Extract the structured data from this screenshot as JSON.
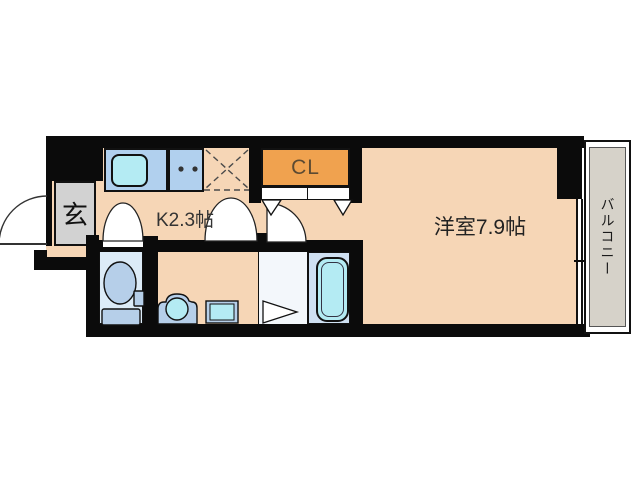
{
  "plan": {
    "type": "apartment-floor-plan",
    "rooms": {
      "entrance": {
        "label": "玄"
      },
      "kitchen": {
        "label": "K2.3帖"
      },
      "closet": {
        "label": "CL"
      },
      "main_room": {
        "label": "洋室7.9帖"
      },
      "balcony": {
        "label": "バルコニー"
      }
    },
    "features": [
      "sink",
      "two-burner-stove",
      "refrigerator-space",
      "toilet",
      "washing-machine-pan",
      "vanity-sink",
      "bathtub",
      "sliding-window"
    ]
  },
  "colors": {
    "wall": "#0b0b0b",
    "floor": "#f6d6b6",
    "closet": "#f0a24f",
    "entrance_floor": "#d2d2d2",
    "counter": "#b1d0ee",
    "water": "#b4ebf3",
    "fixture": "#b6cfe9",
    "toilet_room": "#dcebf7",
    "bathroom": "#cfe0f2",
    "balcony_floor": "#d6d2c9"
  }
}
